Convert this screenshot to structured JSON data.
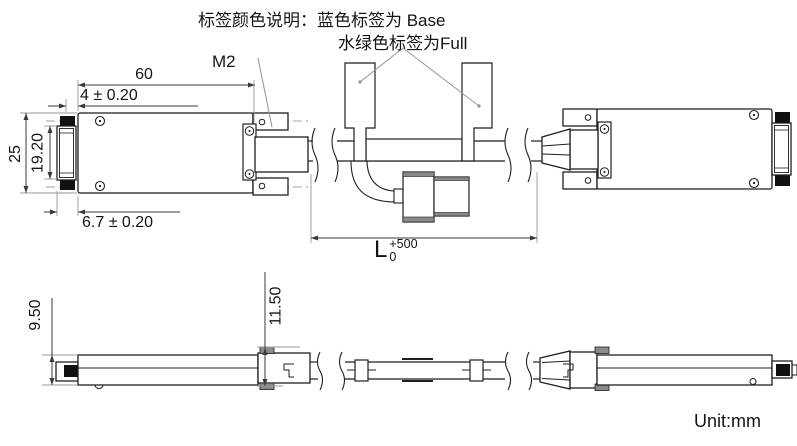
{
  "note": {
    "line1": "标签颜色说明：蓝色标签为 Base",
    "line2": "水绿色标签为Full"
  },
  "top_view": {
    "dims": {
      "body_width": "60",
      "offset_top": "4 ± 0.20",
      "body_height": "25",
      "connector_height": "19.20",
      "offset_bottom": "6.7 ± 0.20",
      "thread_callout": "M2",
      "cable_length": {
        "base": "L",
        "sup": "+500",
        "sub": "0"
      }
    }
  },
  "bottom_view": {
    "dims": {
      "body_height": "9.50",
      "connector_height": "11.50"
    }
  },
  "footer": {
    "unit_label": "Unit:mm"
  },
  "colors": {
    "outline": "#1f1f1f",
    "dimension": "#3a3a3a",
    "extension": "#999999",
    "centerline": "#b5b5b5",
    "black_fill": "#111111",
    "gray_cap": "#8a8a8a"
  }
}
